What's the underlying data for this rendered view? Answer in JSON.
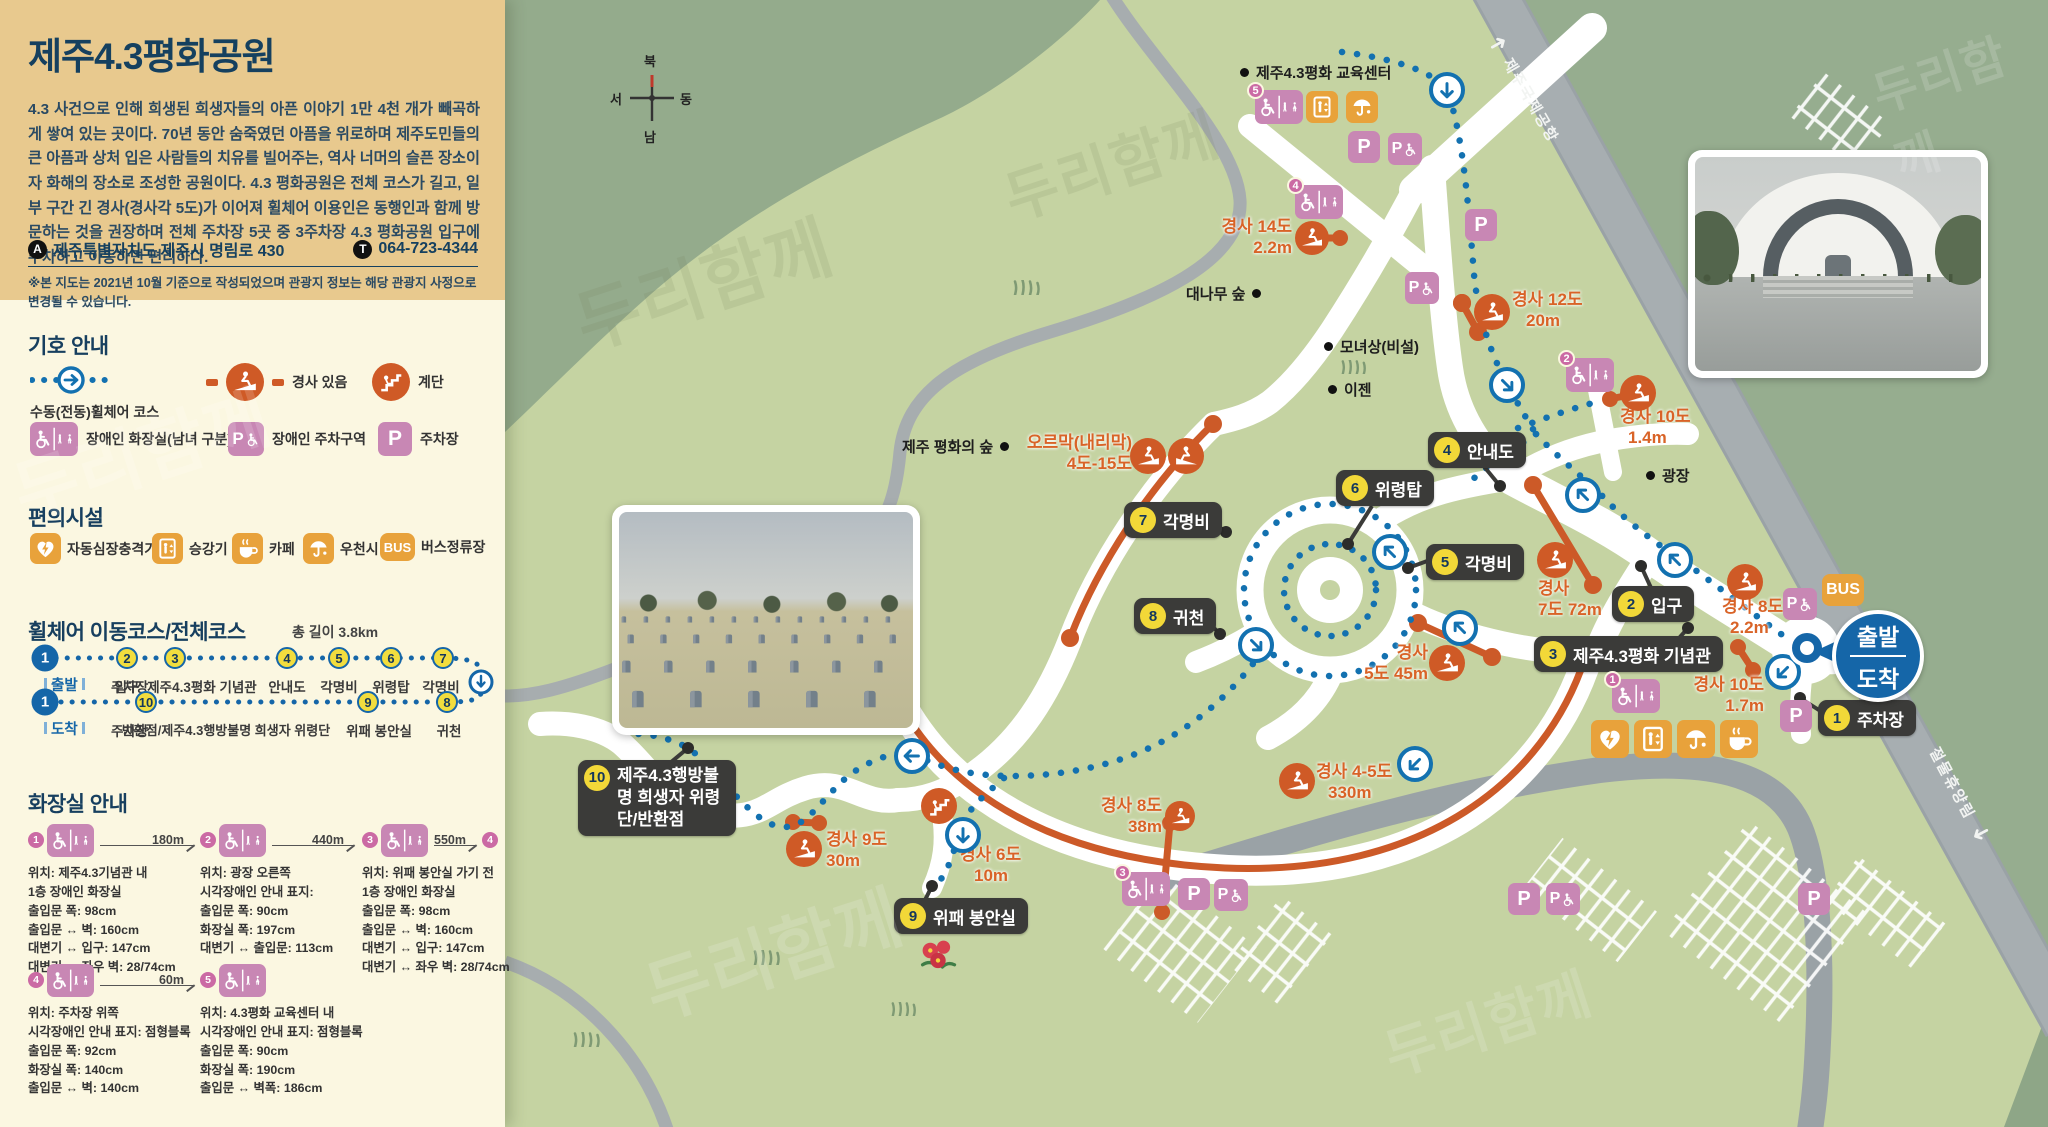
{
  "icons": {
    "parking": "P",
    "bus": "BUS"
  },
  "sidebar": {
    "title": "제주4.3평화공원",
    "description": "4.3 사건으로 인해 희생된 희생자들의 아픈 이야기 1만 4천 개가 빼곡하게 쌓여 있는 곳이다. 70년 동안 숨죽였던 아픔을 위로하며 제주도민들의 큰 아픔과 상처 입은 사람들의 치유를 빌어주는, 역사 너머의 슬픈 장소이자 화해의 장소로 조성한 공원이다. 4.3 평화공원은 전체 코스가 길고, 일부 구간 긴 경사(경사각 5도)가 이어져 휠체어 이용인은 동행인과 함께 방문하는 것을 권장하며 전체 주차장 5곳 중 3주차장 4.3 평화공원 입구에 주차하고 이동하면 편리하다.",
    "address_badge": "A",
    "address": "제주특별자치도 제주시 명림로 430",
    "phone_badge": "T",
    "phone": "064-723-4344",
    "note": "※본 지도는 2021년 10월 기준으로 작성되었으며 관광지 정보는 해당 관광지 사정으로 변경될 수 있습니다.",
    "legend": {
      "title": "기호 안내",
      "items": [
        {
          "label": "수동(전동)휠체어 코스"
        },
        {
          "label": "경사 있음"
        },
        {
          "label": "계단"
        },
        {
          "label": "장애인 화장실(남녀 구분)"
        },
        {
          "label": "장애인 주차구역"
        },
        {
          "label": "주차장"
        }
      ]
    },
    "facilities": {
      "title": "편의시설",
      "items": [
        {
          "label": "자동심장충격기"
        },
        {
          "label": "승강기"
        },
        {
          "label": "카페"
        },
        {
          "label": "우천시"
        },
        {
          "label": "버스정류장"
        }
      ]
    },
    "course": {
      "title": "휠체어 이동코스/전체코스",
      "total": "총 길이 3.8km",
      "row1_tag": "출발",
      "row2_tag": "도착",
      "row1": [
        {
          "num": "1",
          "label": "주차장"
        },
        {
          "num": "2",
          "label": "입구"
        },
        {
          "num": "3",
          "label": "제주4.3평화 기념관"
        },
        {
          "num": "4",
          "label": "안내도"
        },
        {
          "num": "5",
          "label": "각명비"
        },
        {
          "num": "6",
          "label": "위령탑"
        },
        {
          "num": "7",
          "label": "각명비"
        }
      ],
      "row2": [
        {
          "num": "1",
          "label": "주차장"
        },
        {
          "num": "10",
          "label": "반환점/제주4.3행방불명 희생자 위령단"
        },
        {
          "num": "9",
          "label": "위패 봉안실"
        },
        {
          "num": "8",
          "label": "귀천"
        }
      ]
    },
    "restrooms": {
      "title": "화장실 안내",
      "cards": [
        {
          "no": "1",
          "distance": "180m",
          "next": "",
          "lines": [
            "위치: 제주4.3기념관 내",
            "1층 장애인 화장실",
            "출입문 폭: 98cm",
            "출입문 ↔ 벽: 160cm",
            "대변기 ↔ 입구: 147cm",
            "대변기 ↔ 좌우 벽: 28/74cm"
          ]
        },
        {
          "no": "2",
          "distance": "440m",
          "next": "",
          "lines": [
            "위치: 광장 오른쪽",
            "시각장애인 안내 표지:",
            "출입문 폭: 90cm",
            "화장실 폭: 197cm",
            "대변기 ↔ 출입문: 113cm"
          ]
        },
        {
          "no": "3",
          "distance": "550m",
          "next": "4",
          "lines": [
            "위치: 위패 봉안실 가기 전",
            "1층 장애인 화장실",
            "출입문 폭: 98cm",
            "출입문 ↔ 벽: 160cm",
            "대변기 ↔ 입구: 147cm",
            "대변기 ↔ 좌우 벽: 28/74cm"
          ]
        },
        {
          "no": "4",
          "distance": "60m",
          "next": "",
          "lines": [
            "위치: 주차장 위쪽",
            "시각장애인 안내 표지: 점형블록",
            "출입문 폭: 92cm",
            "화장실 폭: 140cm",
            "출입문 ↔ 벽: 140cm"
          ]
        },
        {
          "no": "5",
          "distance": "",
          "next": "",
          "lines": [
            "위치: 4.3평화 교육센터 내",
            "시각장애인 안내 표지: 점형블록",
            "출입문 폭: 90cm",
            "화장실 폭: 190cm",
            "출입문 ↔ 벽폭: 186cm"
          ]
        }
      ]
    }
  },
  "map": {
    "compass": {
      "north": "북",
      "south": "남",
      "west": "서",
      "east": "동"
    },
    "road_airport": "제주국제공항",
    "road_forest": "절물휴양림",
    "pois": [
      {
        "label": "제주4.3평화 교육센터"
      },
      {
        "label": "대나무 숲"
      },
      {
        "label": "모녀상(비설)"
      },
      {
        "label": "이젠"
      },
      {
        "label": "제주 평화의 숲"
      },
      {
        "label": "광장"
      }
    ],
    "stops": [
      {
        "num": "1",
        "label": "주차장"
      },
      {
        "num": "2",
        "label": "입구"
      },
      {
        "num": "3",
        "label": "제주4.3평화 기념관"
      },
      {
        "num": "4",
        "label": "안내도"
      },
      {
        "num": "5",
        "label": "각명비"
      },
      {
        "num": "6",
        "label": "위령탑"
      },
      {
        "num": "7",
        "label": "각명비"
      },
      {
        "num": "8",
        "label": "귀천"
      },
      {
        "num": "9",
        "label": "위패 봉안실"
      },
      {
        "num": "10",
        "label": "제주4.3행방불명 희생자 위령단/반환점"
      }
    ],
    "slopes": [
      {
        "text": "경사 14도",
        "value": "2.2m"
      },
      {
        "text": "경사 12도",
        "value": "20m"
      },
      {
        "text": "경사 10도",
        "value": "1.4m"
      },
      {
        "text": "경사",
        "value": "7도 72m"
      },
      {
        "text": "경사",
        "value": "5도 45m"
      },
      {
        "text": "경사 4-5도",
        "value": "330m"
      },
      {
        "text": "경사 8도",
        "value": "38m"
      },
      {
        "text": "경사 6도",
        "value": "10m"
      },
      {
        "text": "경사 9도",
        "value": "30m"
      },
      {
        "text": "경사 8도",
        "value": "2.2m"
      },
      {
        "text": "경사 10도",
        "value": "1.7m"
      },
      {
        "text": "오르막(내리막)",
        "value": "4도-15도"
      }
    ],
    "start_badge": {
      "top": "출발",
      "bottom": "도착"
    },
    "photo_caption": "위패 봉안실"
  },
  "watermark": "두리함께"
}
